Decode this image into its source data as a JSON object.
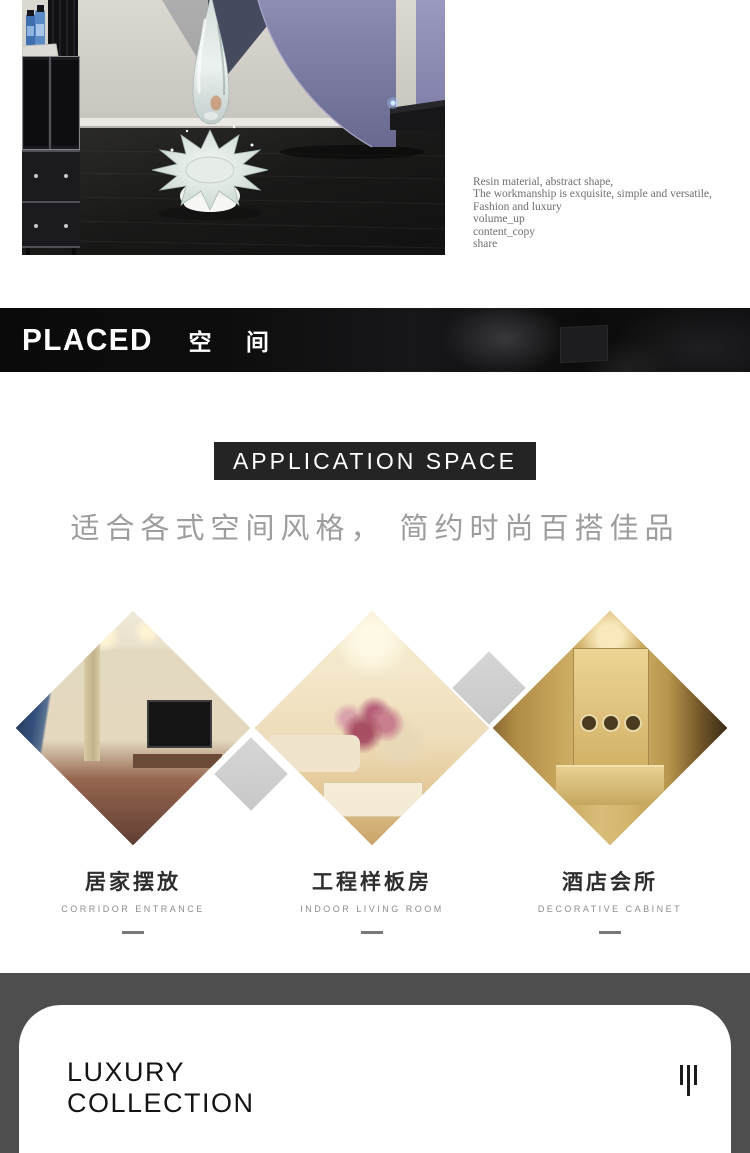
{
  "hero": {
    "photo_alt": "crystal water-drop splash sculpture in a modern interior with purple spiral stair",
    "description": [
      "Resin material, abstract shape,",
      "The workmanship is exquisite, simple and versatile,",
      "Fashion and luxury"
    ],
    "actions": [
      "volume_up",
      "content_copy",
      "share"
    ]
  },
  "placed": {
    "en": "PLACED",
    "cn": "空 间"
  },
  "application": {
    "header": "APPLICATION SPACE",
    "subtitle": "适合各式空间风格， 简约时尚百搭佳品"
  },
  "spaces": [
    {
      "cn": "居家摆放",
      "en": "CORRIDOR ENTRANCE"
    },
    {
      "cn": "工程样板房",
      "en": "INDOOR LIVING ROOM"
    },
    {
      "cn": "酒店会所",
      "en": "DECORATIVE CABINET"
    }
  ],
  "footer": {
    "line1": "LUXURY",
    "line2": "COLLECTION"
  },
  "icons": {
    "footer": "three-vertical-bars"
  },
  "colors": {
    "banner_bg": "#0c0c0c",
    "header_box_bg": "#242424",
    "footer_band": "#4e4e4e",
    "accent_purple": "#7a7aa2",
    "gray_diamond": "#d0d0d0",
    "subtitle_gray": "#9d9d9d"
  }
}
